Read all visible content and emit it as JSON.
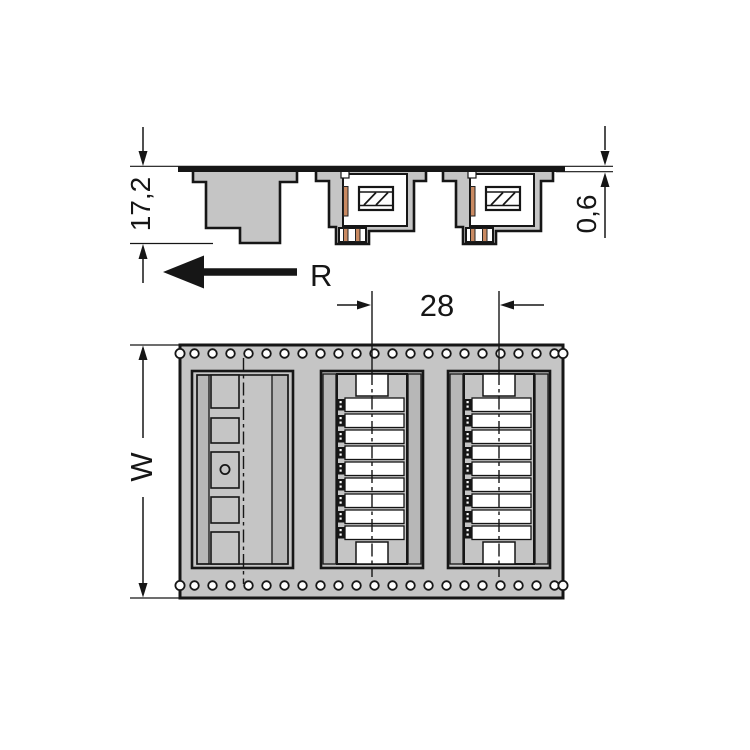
{
  "side_view": {
    "height_dim": "17,2",
    "tape_thickness_dim": "0,6",
    "unreel_direction_label": "R",
    "pockets_shown": 3,
    "empty_pockets": 1,
    "connector_pockets": 2
  },
  "top_view": {
    "pitch_dim": "28",
    "tape_width_dim": "W",
    "sprocket_holes_per_row": 21,
    "sprocket_hole_rows": 2,
    "slots_per_connector": 9,
    "empty_pocket_compartments": 5,
    "connector_pockets": 2
  },
  "colors": {
    "tape_gray": "#c5c5c5",
    "wall_gray": "#b7b7b7",
    "outline": "#161616",
    "pin_copper": "#c98a62",
    "slot_white": "#ffffff"
  }
}
